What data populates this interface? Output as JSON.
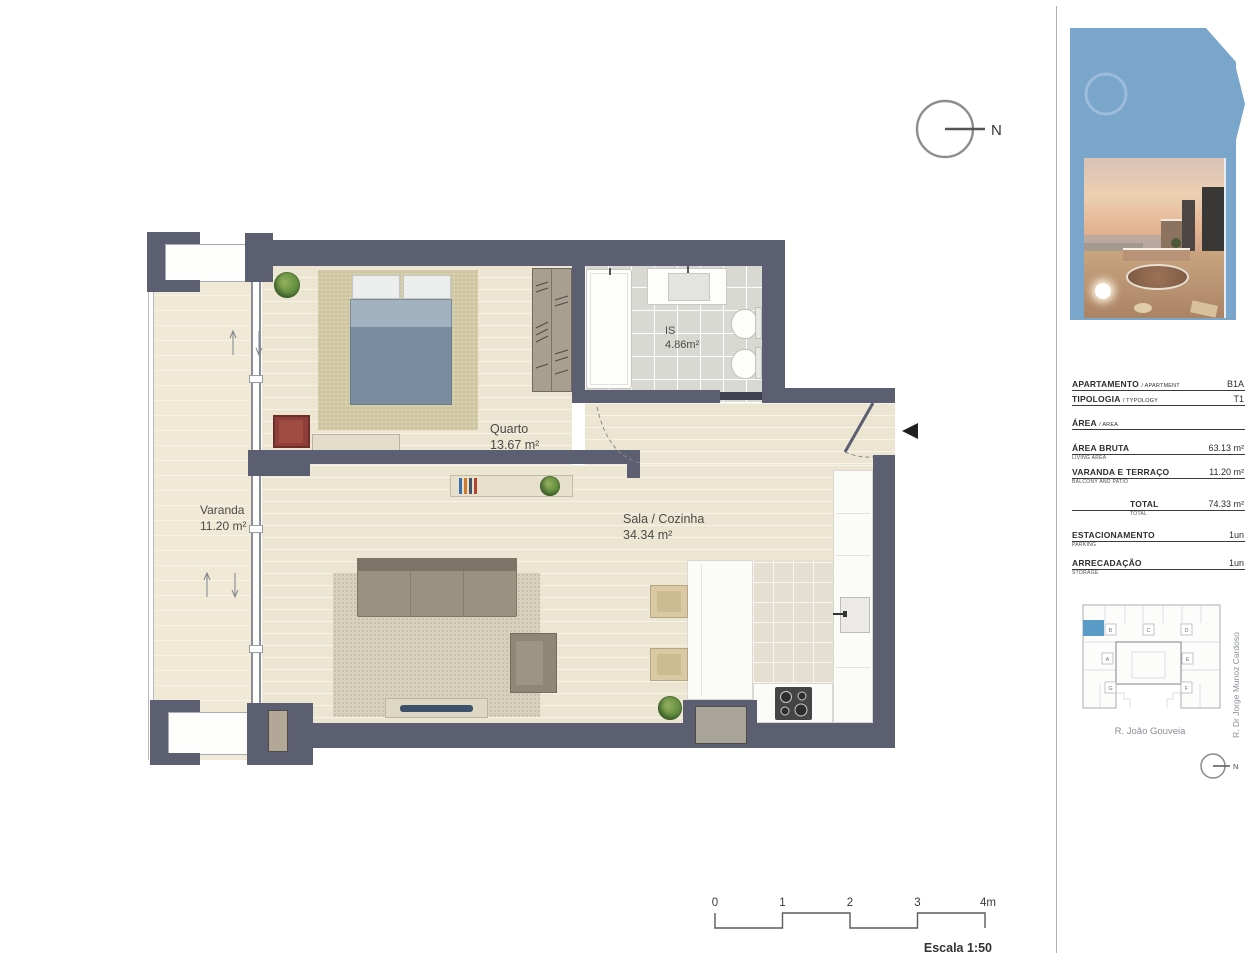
{
  "north_arrow": {
    "label": "N"
  },
  "floor_plan": {
    "watermark": "CONSULTORES",
    "rooms": [
      {
        "name": "Quarto",
        "area": "13.67 m²"
      },
      {
        "name": "Sala / Cozinha",
        "area": "34.34 m²"
      },
      {
        "name": "IS",
        "area": "4.86m²"
      },
      {
        "name": "Varanda",
        "area": "11.20 m²"
      }
    ]
  },
  "scale_bar": {
    "ticks": [
      "0",
      "1",
      "2",
      "3",
      "4m"
    ],
    "caption": "Escala 1:50"
  },
  "sidebar": {
    "details": {
      "rows": [
        {
          "label": "APARTAMENTO",
          "sub": "/ APARTMENT",
          "value": "B1A"
        },
        {
          "label": "TIPOLOGIA",
          "sub": "/ TYPOLOGY",
          "value": "T1"
        },
        {
          "label": "ÁREA",
          "sub": "/ AREA",
          "value": ""
        },
        {
          "label": "ÁREA BRUTA",
          "sub": "LIVING AREA",
          "value": "63.13 m²"
        },
        {
          "label": "VARANDA E TERRAÇO",
          "sub": "BALCONY AND PATIO",
          "value": "11.20 m²"
        },
        {
          "label": "TOTAL",
          "sub": "TOTAL",
          "value": "74.33 m²"
        },
        {
          "label": "ESTACIONAMENTO",
          "sub": "PARKING",
          "value": "1un"
        },
        {
          "label": "ARRECADAÇÃO",
          "sub": "STORAGE",
          "value": "1un"
        }
      ]
    },
    "site_plan": {
      "units": [
        "B",
        "C",
        "D",
        "A",
        "E",
        "G",
        "F"
      ],
      "street_bottom": "R. João Gouveia",
      "street_right": "R. Dr Jorge Munoz Cardoso",
      "north_label": "N",
      "highlight_color": "#5b9bc8"
    }
  },
  "colors": {
    "wall": "#5c5f72",
    "accent_blue": "#7ba6cc",
    "highlight_unit": "#5b9bc8"
  }
}
